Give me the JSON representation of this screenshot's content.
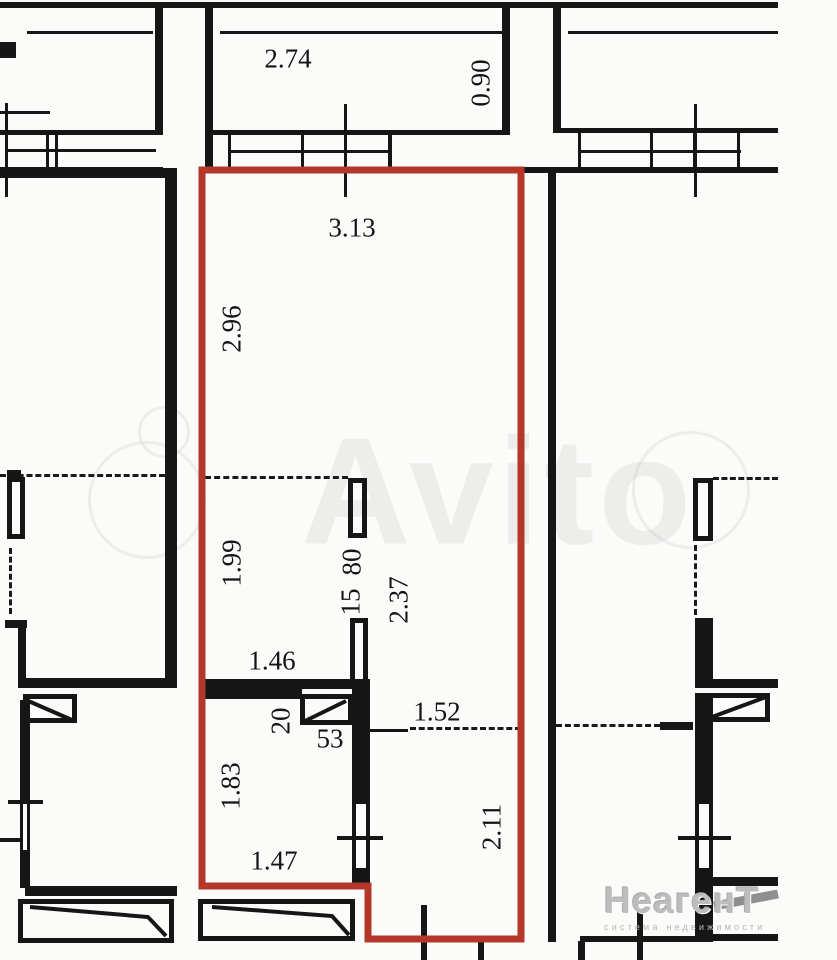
{
  "plan": {
    "type": "apartment-floor-plan",
    "highlighted_unit_outline_color": "#b5372a",
    "wall_color": "#161616",
    "background_color": "#fbfbfa",
    "dims": {
      "d274": "2.74",
      "d090": "0.90",
      "d313": "3.13",
      "d296": "2.96",
      "d199": "1.99",
      "d80": "80",
      "d15": "15",
      "d237": "2.37",
      "d146": "1.46",
      "d20": "20",
      "d53": "53",
      "d152": "1.52",
      "d183": "1.83",
      "d147": "1.47",
      "d211": "2.11"
    },
    "watermark": {
      "brand": "Avito",
      "agency": "НеагенТ",
      "agency_tagline": "система недвижимости"
    }
  }
}
